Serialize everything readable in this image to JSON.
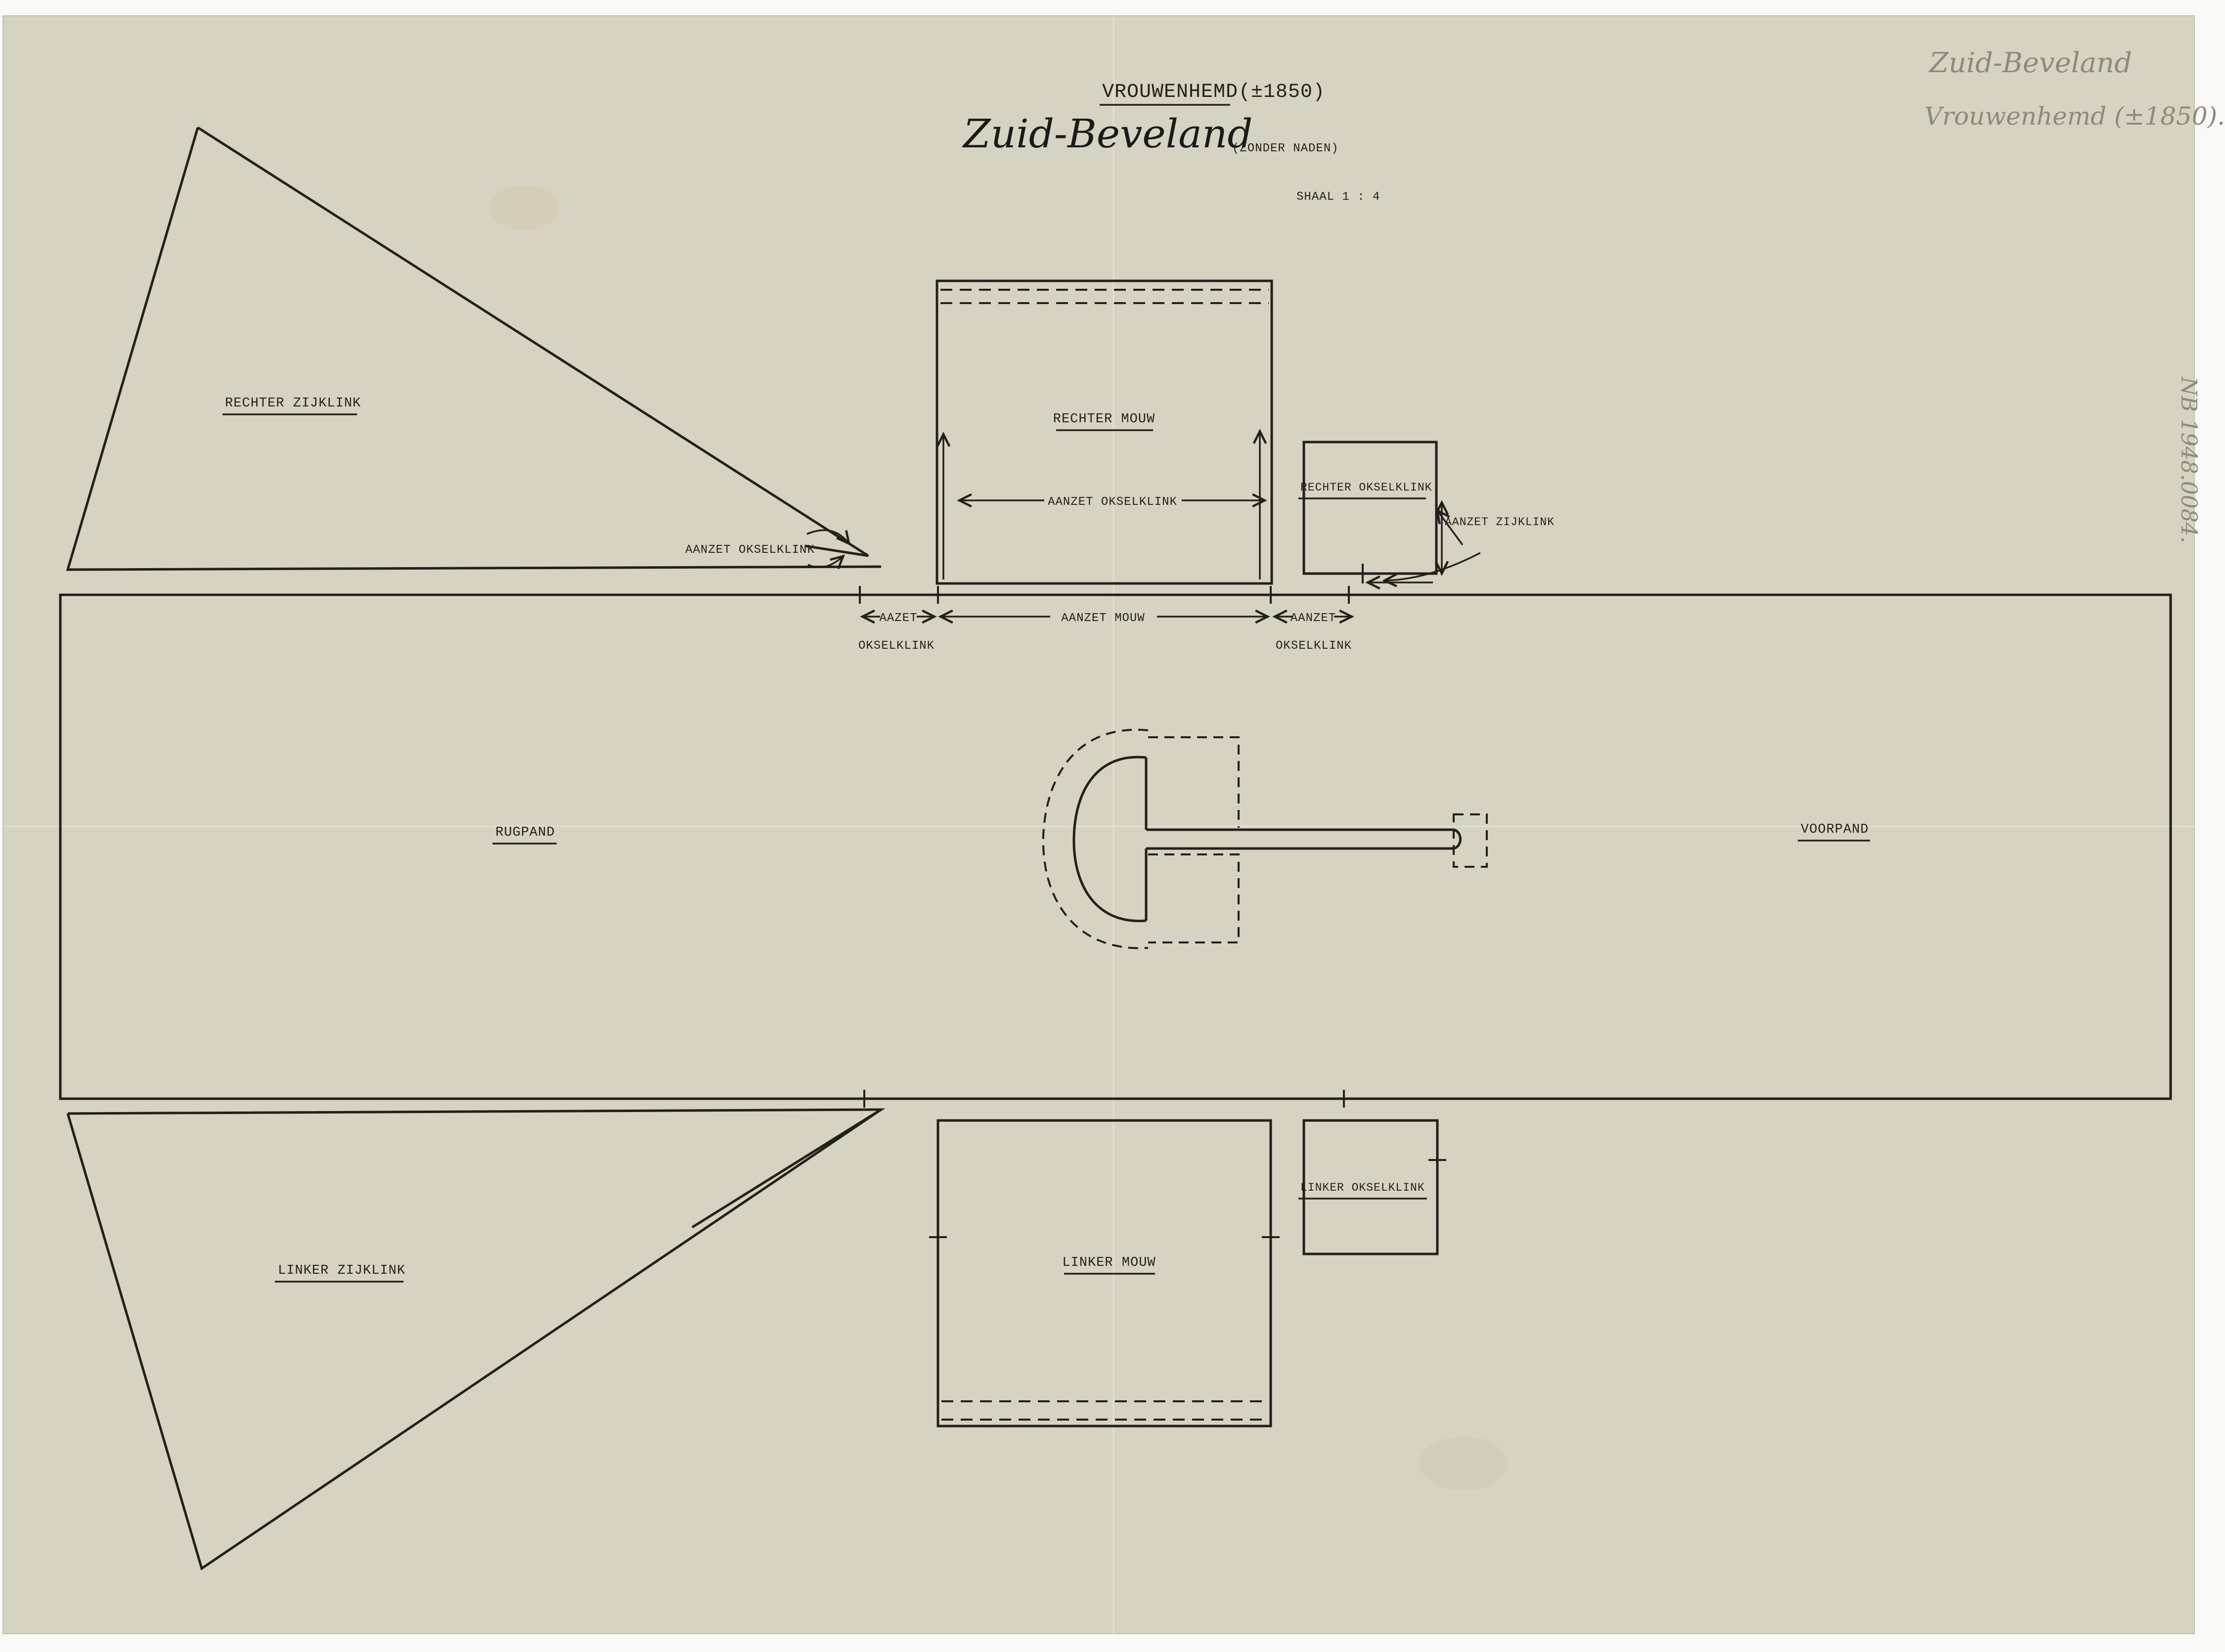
{
  "header": {
    "title_name": "VROUWENHEMD",
    "title_year": "(±1850)",
    "region_handwritten": "Zuid-Beveland",
    "subtitle": "(ZONDER NADEN)",
    "scale_label": "SHAAL 1 : 4"
  },
  "pencil_annotations": {
    "line1": "Zuid-Beveland",
    "line2": "Vrouwenhemd (±1850).",
    "inventory_number": "NB 1948.0084."
  },
  "piece_labels": {
    "right_side_gusset": "RECHTER ZIJKLINK",
    "right_sleeve": "RECHTER MOUW",
    "right_armpit_gusset": "RECHTER OKSELKLINK",
    "back_panel": "RUGPAND",
    "front_panel": "VOORPAND",
    "left_side_gusset": "LINKER ZIJKLINK",
    "left_sleeve": "LINKER MOUW",
    "left_armpit_gusset": "LINKER OKSELKLINK"
  },
  "seam_annotations": {
    "sleeve_inner_dim": "AANZET OKSELKLINK",
    "side_gusset_tip": "AANZET OKSELKLINK",
    "armpit_side_attach": "AANZET ZIJKLINK",
    "dim_left_line1": "AAZET",
    "dim_left_line2": "OKSELKLINK",
    "dim_middle": "AANZET MOUW",
    "dim_right_line1": "AANZET",
    "dim_right_line2": "OKSELKLINK"
  },
  "colors": {
    "paper": "#d7d3c3",
    "ink": "#241f19",
    "pencil": "#8d897d",
    "scan_background": "#f9f9f8"
  }
}
